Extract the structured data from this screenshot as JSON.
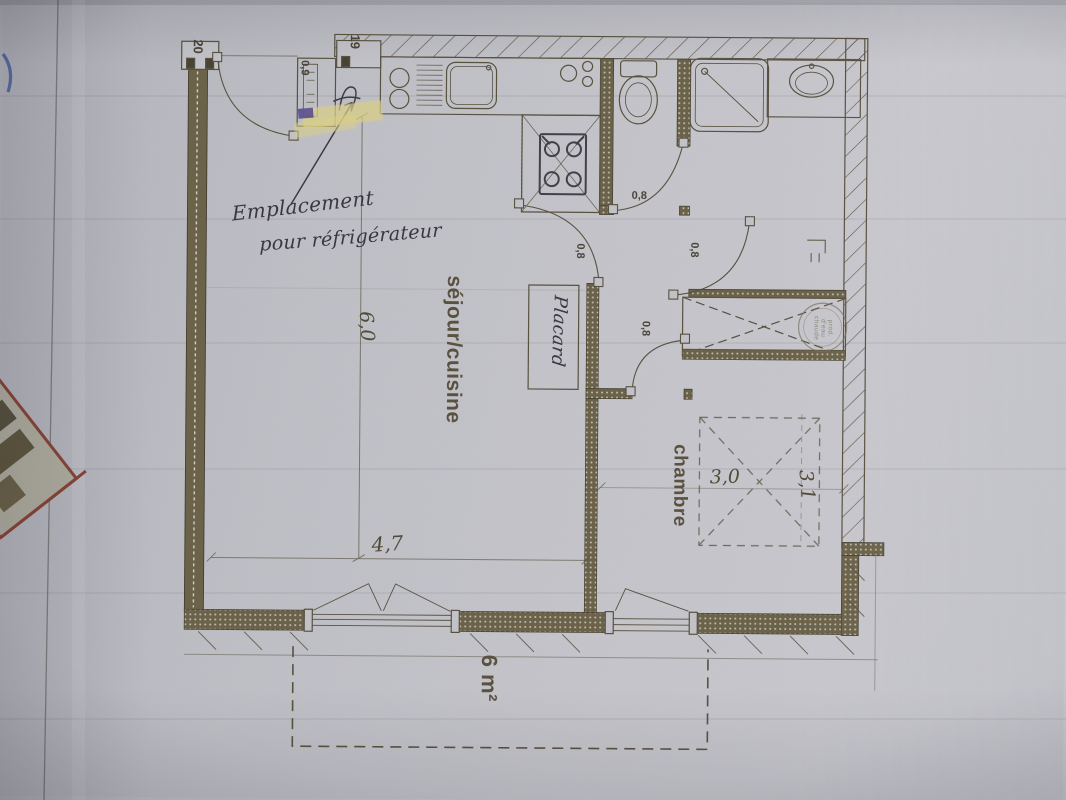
{
  "colors": {
    "paper": "#c2c3c9",
    "ink": "#57503d",
    "dark_wall": "#6b6147",
    "handwriting": "#3a3643",
    "highlighter": "#d8ce85",
    "red_fragment": "#8a4233",
    "blue_mark": "#3f5a9e"
  },
  "plan": {
    "grid_refs": {
      "left": "20",
      "right": "19"
    },
    "entrance": {
      "door_width": "0,9"
    },
    "rooms": {
      "living": {
        "label": "séjour/cuisine",
        "width": "4,7",
        "depth": "6,0"
      },
      "bedroom": {
        "label": "chambre",
        "width": "3,0",
        "depth": "3,1"
      },
      "closet": {
        "label": "Placard"
      },
      "balcony": {
        "area": "6 m²"
      }
    },
    "doors": {
      "wc": "0,8",
      "living": "0,8",
      "bathroom": "0,8",
      "bedroom": "0,8"
    },
    "annotation": {
      "line1": "Emplacement",
      "line2": "pour réfrigérateur"
    },
    "stamp": {
      "line1": "prod.",
      "line2": "d'eau",
      "line3": "chaude"
    }
  }
}
